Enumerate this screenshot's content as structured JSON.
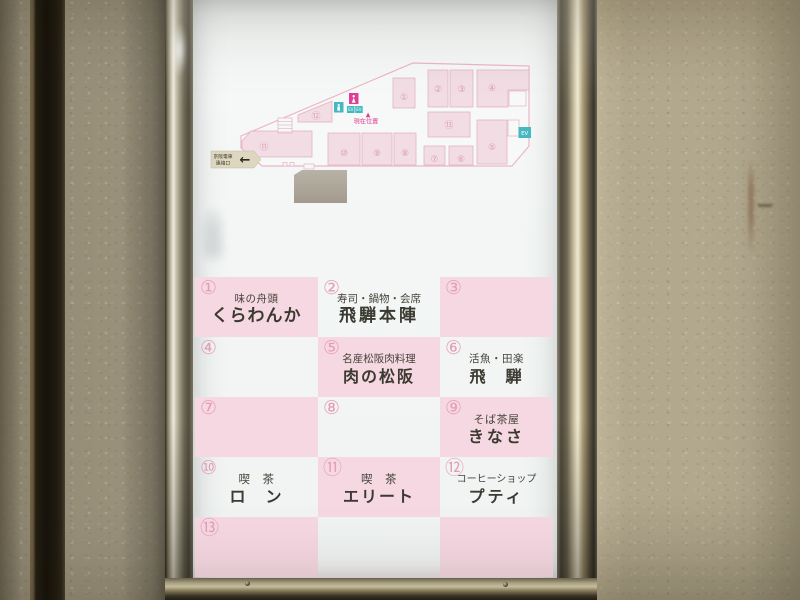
{
  "map": {
    "exit_sign": {
      "line1": "京阪電車",
      "line2": "連絡口",
      "arrow": "←"
    },
    "current_location": {
      "marker": "▲",
      "label": "現在位置"
    },
    "elevator_label": "EV",
    "room_numbers": [
      "①",
      "②",
      "③",
      "④",
      "⑤",
      "⑥",
      "⑦",
      "⑧",
      "⑨",
      "⑩",
      "⑪",
      "⑫",
      "⑬"
    ]
  },
  "directory": {
    "cells": [
      {
        "num": "①",
        "genre": "味の舟頭",
        "name": "くらわんか"
      },
      {
        "num": "②",
        "genre": "寿司・鍋物・会席",
        "name": "飛騨本陣"
      },
      {
        "num": "③",
        "genre": "",
        "name": ""
      },
      {
        "num": "④",
        "genre": "",
        "name": ""
      },
      {
        "num": "⑤",
        "genre": "名産松阪肉料理",
        "name": "肉の松阪"
      },
      {
        "num": "⑥",
        "genre": "活魚・田楽",
        "name": "飛　騨"
      },
      {
        "num": "⑦",
        "genre": "",
        "name": ""
      },
      {
        "num": "⑧",
        "genre": "",
        "name": ""
      },
      {
        "num": "⑨",
        "genre": "そば茶屋",
        "name": "きなさ"
      },
      {
        "num": "⑩",
        "genre": "喫　茶",
        "name": "ロ　ン"
      },
      {
        "num": "⑪",
        "genre": "喫　茶",
        "name": "エリート"
      },
      {
        "num": "⑫",
        "genre": "コーヒーショップ",
        "name": "プティ"
      },
      {
        "num": "⑬",
        "genre": "",
        "name": ""
      }
    ]
  },
  "colors": {
    "cell_pink": "#f6d8e2",
    "panel_white": "#f3f6f5",
    "map_room_pink": "#f3dde5",
    "map_outline_pink": "#ecb6c9",
    "number_pink": "#e49fb8",
    "accent_magenta": "#e23d96",
    "accent_teal": "#45b8c1",
    "wall_beige": "#b2a88e",
    "frame_bronze": "#a89a74"
  }
}
